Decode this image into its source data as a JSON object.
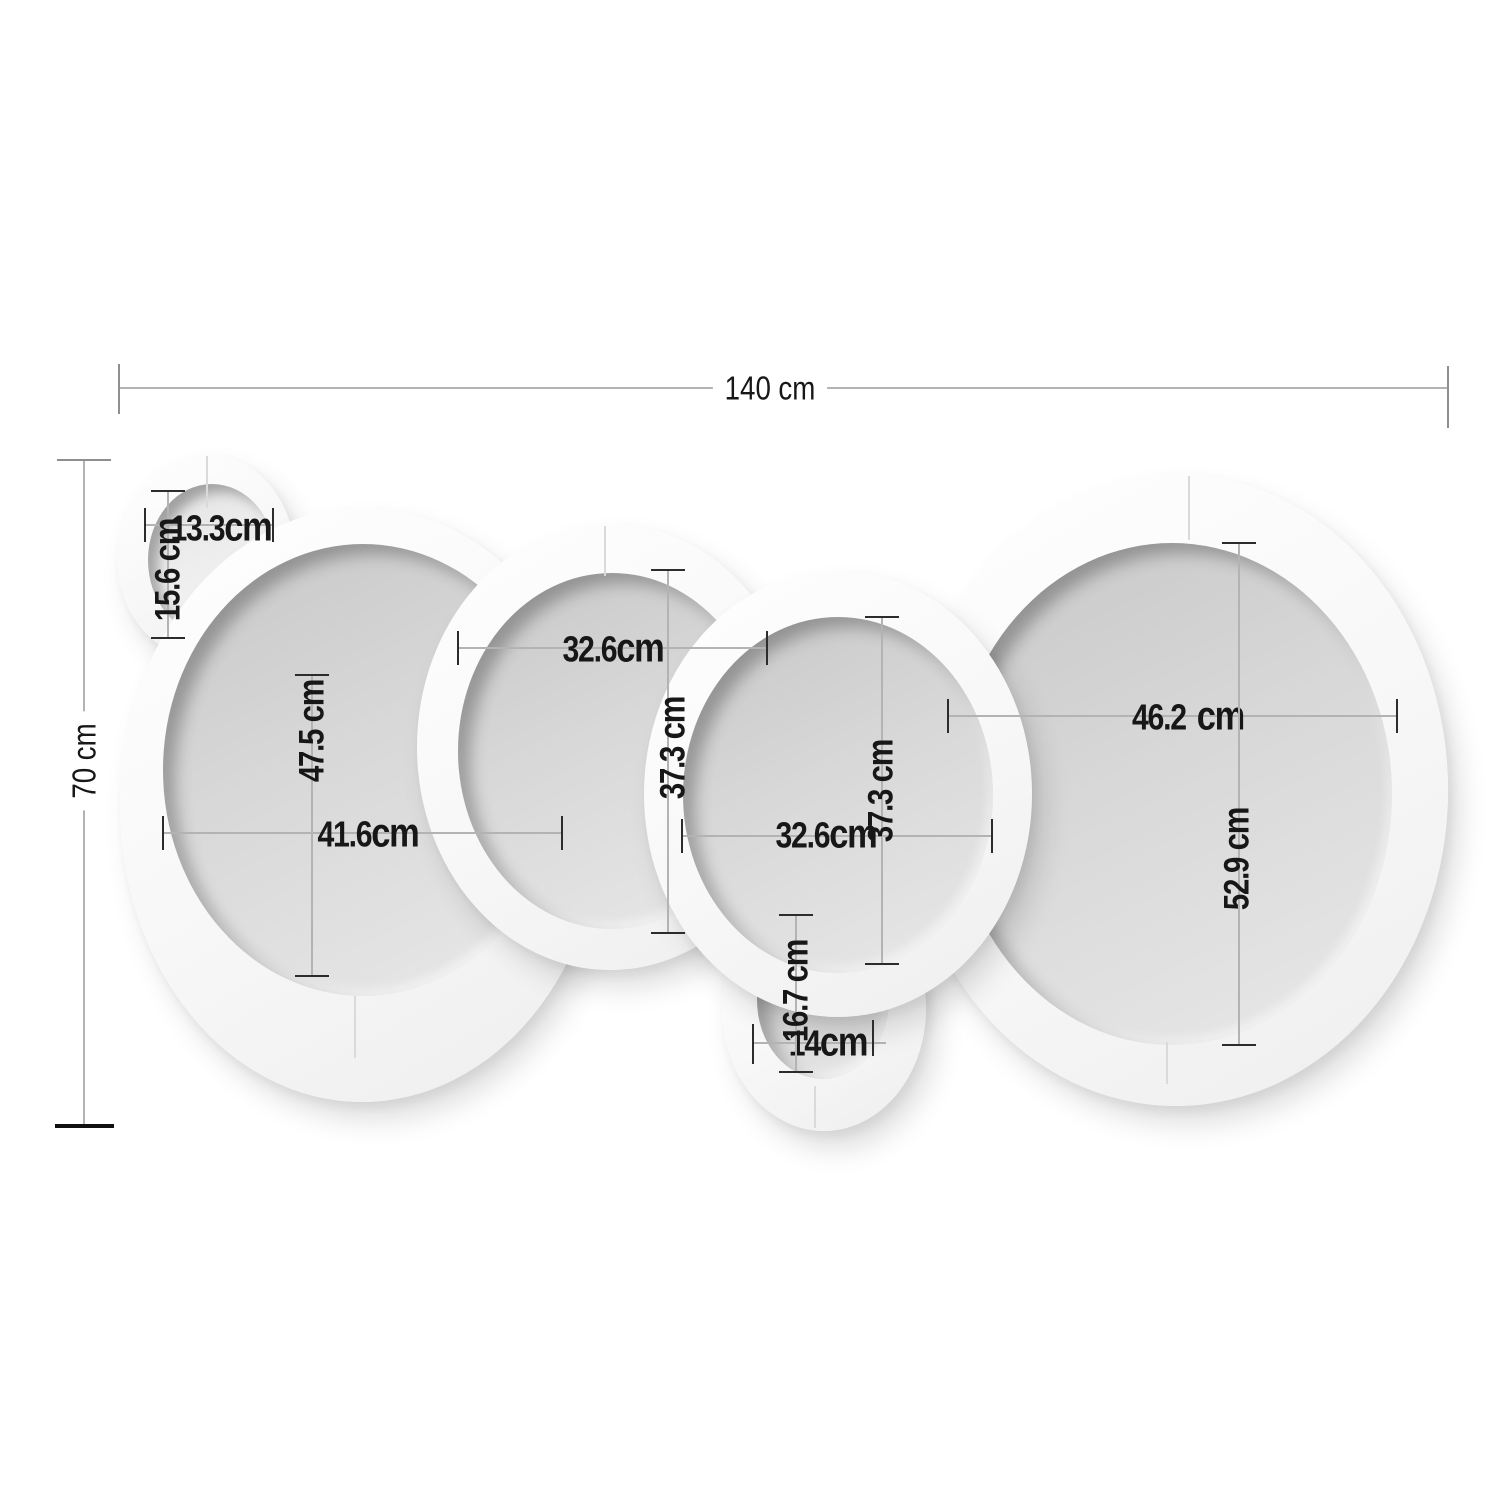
{
  "unit": "cm",
  "colors": {
    "background": "#ffffff",
    "frame": "#f7f7f7",
    "mirror_glass": "#d8d8d8",
    "small_mirror_glass": "#efefef",
    "dimension_line": "#b3b3b3",
    "tick": "#2c2c2c",
    "label_text": "#171717"
  },
  "dims": {
    "overall_w": {
      "value": "140",
      "unit": "cm"
    },
    "overall_h": {
      "value": "70",
      "unit": "cm"
    },
    "c1w": {
      "value": "13.3",
      "unit": "cm"
    },
    "c1h": {
      "value": "15.6",
      "unit": "cm"
    },
    "c2w": {
      "value": "41.6",
      "unit": "cm"
    },
    "c2h": {
      "value": "47.5",
      "unit": "cm"
    },
    "c3w": {
      "value": "32.6",
      "unit": "cm"
    },
    "c3h": {
      "value": "37.3",
      "unit": "cm"
    },
    "c4w": {
      "value": "32.6",
      "unit": "cm"
    },
    "c4h": {
      "value": "37.3",
      "unit": "cm"
    },
    "c5w": {
      "value": "46.2",
      "unit": "cm"
    },
    "c5h": {
      "value": "52.9",
      "unit": "cm"
    },
    "c6w": {
      "value": "14",
      "unit": "cm"
    },
    "c6h": {
      "value": "16.7",
      "unit": "cm"
    }
  }
}
